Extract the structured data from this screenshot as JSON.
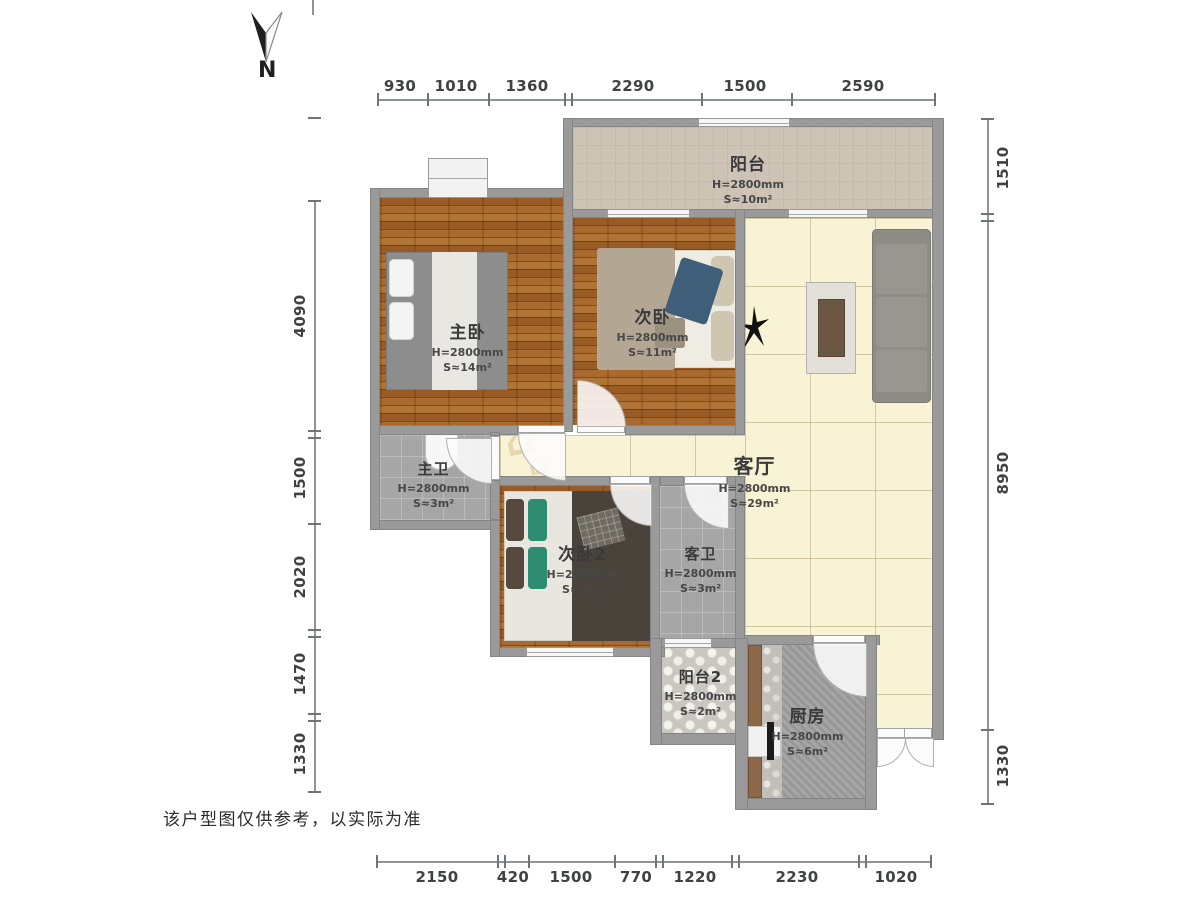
{
  "north_label": "N",
  "note": "该户型图仅供参考，以实际为准",
  "dims": {
    "top": [
      "930",
      "1010",
      "1360",
      "2290",
      "1500",
      "2590"
    ],
    "bottom": [
      "2150",
      "420",
      "1500",
      "770",
      "1220",
      "2230",
      "1020"
    ],
    "left": [
      "4090",
      "1500",
      "2020",
      "1470",
      "1330"
    ],
    "right": [
      "1510",
      "8950",
      "1330"
    ]
  },
  "rooms": {
    "balcony": {
      "name": "阳台",
      "height": "H=2800mm",
      "area": "S≈10m²"
    },
    "master_bedroom": {
      "name": "主卧",
      "height": "H=2800mm",
      "area": "S≈14m²"
    },
    "second_bedroom": {
      "name": "次卧",
      "height": "H=2800mm",
      "area": "S≈11m²"
    },
    "living_room": {
      "name": "客厅",
      "height": "H=2800mm",
      "area": "S≈29m²"
    },
    "master_bath": {
      "name": "主卫",
      "height": "H=2800mm",
      "area": "S≈3m²"
    },
    "second_bedroom2": {
      "name": "次卧2",
      "height": "H=2800mm",
      "area": "S≈7m²"
    },
    "guest_bath": {
      "name": "客卫",
      "height": "H=2800mm",
      "area": "S≈3m²"
    },
    "balcony2": {
      "name": "阳台2",
      "height": "H=2800mm",
      "area": "S≈2m²"
    },
    "kitchen": {
      "name": "厨房",
      "height": "H=2800mm",
      "area": "S≈6m²"
    }
  },
  "colors": {
    "wall": "#9a9a9a",
    "wood": "#9a5c26",
    "living_tile": "#f8f3d5",
    "bath": "#a6a6a6",
    "balcony_floor": "#cdc4b6",
    "text": "#3f4245"
  }
}
